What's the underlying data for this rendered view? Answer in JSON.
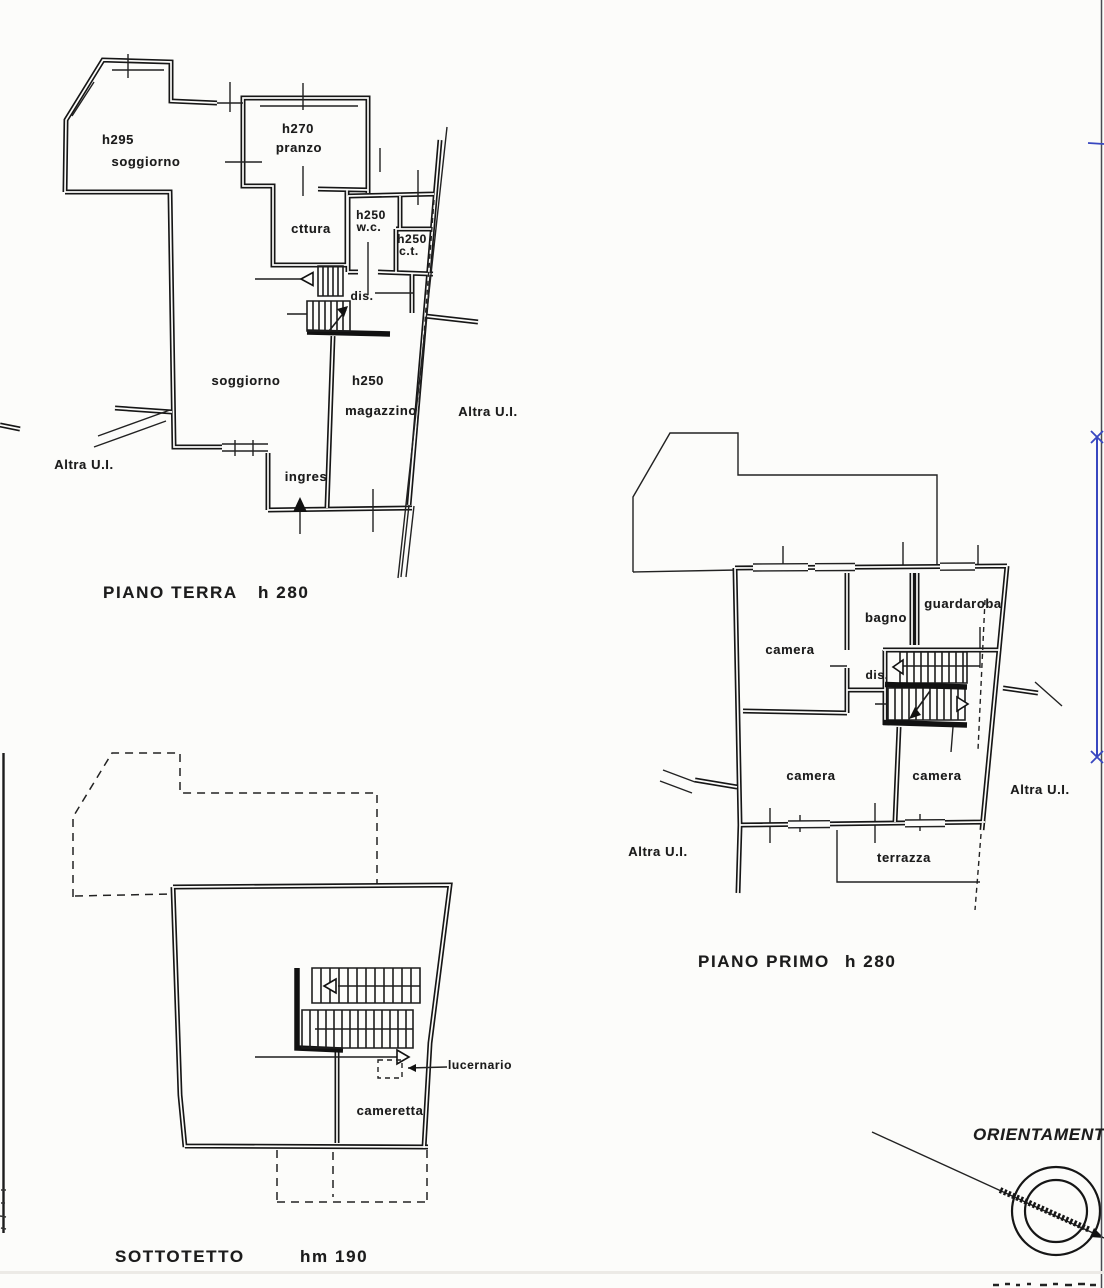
{
  "colors": {
    "paper": "#fcfcfa",
    "ink": "#1a1a1a",
    "annotation_blue": "#3847c0"
  },
  "plans": {
    "ground_floor": {
      "title": "PIANO TERRA",
      "height": "h 280",
      "labels": {
        "soggiorno_small_h": "h295",
        "soggiorno_small": "soggiorno",
        "pranzo_h": "h270",
        "pranzo": "pranzo",
        "cottura": "cttura",
        "wc_h": "h250",
        "wc": "w.c.",
        "ct_h": "h250",
        "ct": "c.t.",
        "dis": "dis.",
        "soggiorno_main": "soggiorno",
        "magazzino_h": "h250",
        "magazzino": "magazzino",
        "ingresso": "ingres",
        "altra_ui_left": "Altra U.I.",
        "altra_ui_right": "Altra U.I."
      }
    },
    "first_floor": {
      "title": "PIANO PRIMO",
      "height": "h 280",
      "labels": {
        "camera_nw": "camera",
        "bagno": "bagno",
        "guardaroba": "guardaroba",
        "dis": "dis.",
        "camera_sw": "camera",
        "camera_se": "camera",
        "terrazza": "terrazza",
        "altra_ui_left": "Altra U.I.",
        "altra_ui_right": "Altra U.I."
      }
    },
    "attic": {
      "title": "SOTTOTETTO",
      "height": "hm 190",
      "labels": {
        "cameretta": "cameretta",
        "lucernario": "lucernario"
      }
    }
  },
  "compass": {
    "label": "ORIENTAMENT"
  }
}
